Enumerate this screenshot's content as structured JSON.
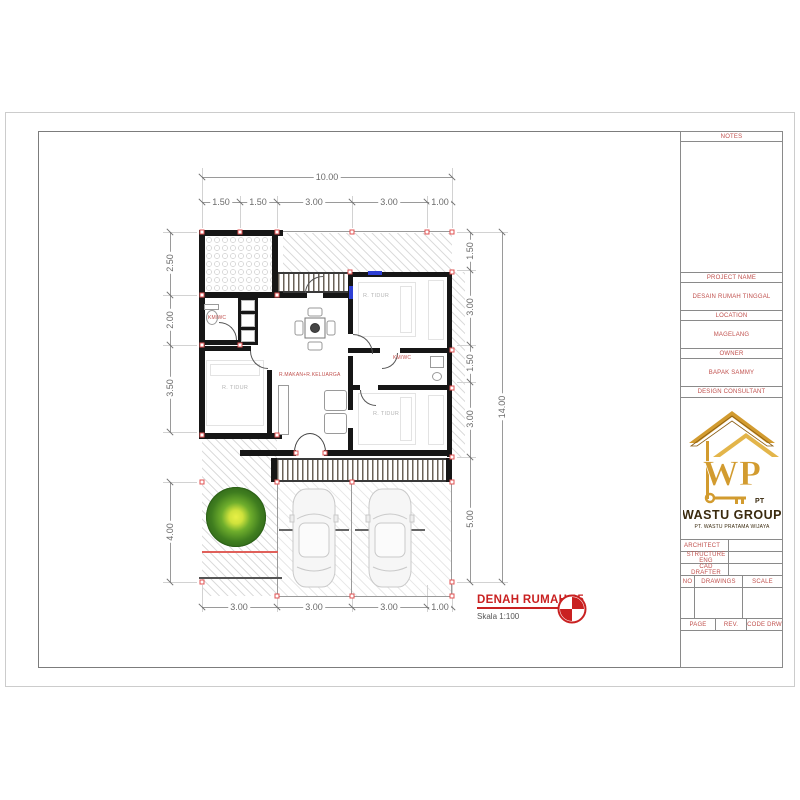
{
  "title_block": {
    "notes_label": "NOTES",
    "project_name_label": "PROJECT NAME",
    "project_name": "DESAIN RUMAH TINGGAL",
    "location_label": "LOCATION",
    "location": "MAGELANG",
    "owner_label": "OWNER",
    "owner": "BAPAK SAMMY",
    "consultant_label": "DESIGN CONSULTANT",
    "staff": [
      "ARCHITECT",
      "STRUCTURE ENG",
      "CAD DRAFTER"
    ],
    "table_headers": [
      "NO",
      "DRAWINGS",
      "SCALE"
    ],
    "footer_headers": [
      "PAGE",
      "REV.",
      "CODE DRW"
    ],
    "logo": {
      "monogram": "WP",
      "pt_label": "PT",
      "company": "WASTU GROUP",
      "subtitle": "PT. WASTU PRATAMA WIJAYA"
    }
  },
  "drawing_title": {
    "name": "DENAH RUMAH 65",
    "scale": "Skala 1:100"
  },
  "plan": {
    "labels": {
      "bedroom": "R. TIDUR",
      "bath": "KM/WC",
      "living": "R.MAKAN+R.KELUARGA"
    },
    "dims": {
      "top_total": "10.00",
      "top": [
        "1.50",
        "1.50",
        "3.00",
        "3.00",
        "1.00"
      ],
      "left": [
        "2.50",
        "2.00",
        "3.50",
        "4.00"
      ],
      "right": [
        "1.50",
        "3.00",
        "1.50",
        "3.00",
        "5.00"
      ],
      "right_total": "14.00",
      "bottom": [
        "3.00",
        "3.00",
        "3.00",
        "1.00"
      ]
    }
  },
  "colors": {
    "marker_red": "#e05050",
    "label_red": "#c0504d",
    "title_red": "#c92121",
    "logo_gold": "#d29b2f",
    "tree_green": "#3f7d1f",
    "tree_core": "#e8f046"
  }
}
